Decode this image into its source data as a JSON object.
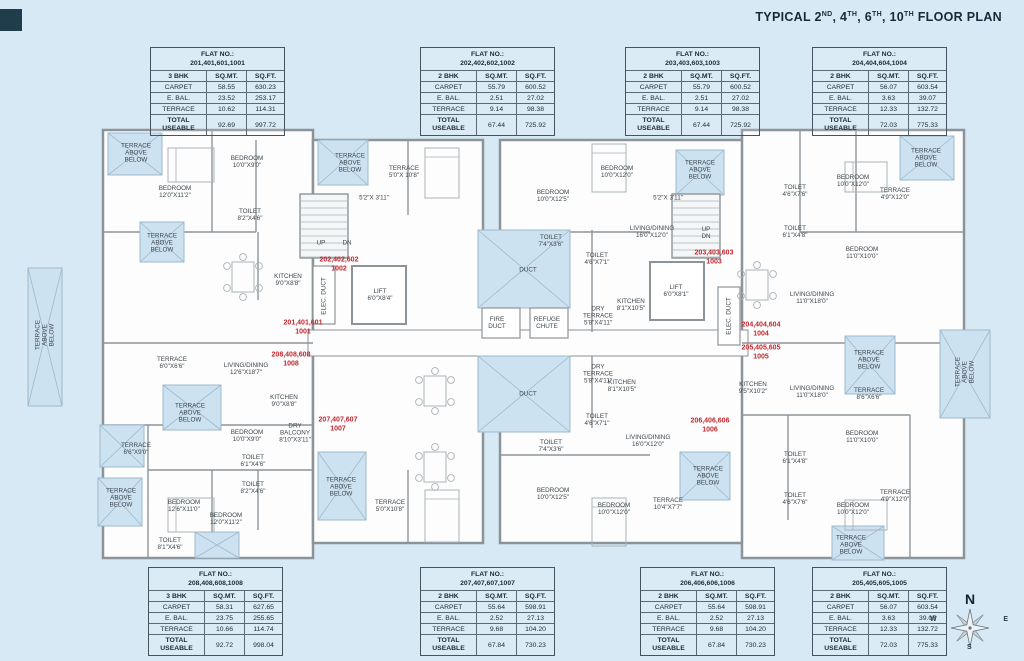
{
  "title": {
    "prefix": "TYPICAL ",
    "floors": [
      {
        "num": "2",
        "sup": "ND"
      },
      {
        "num": "4",
        "sup": "TH"
      },
      {
        "num": "6",
        "sup": "TH"
      },
      {
        "num": "10",
        "sup": "TH"
      }
    ],
    "suffix": " FLOOR PLAN",
    "full": "TYPICAL 2ND, 4TH, 6TH, 10TH FLOOR PLAN"
  },
  "colors": {
    "background": "#d7e9f5",
    "wall": "#8d9499",
    "room_fill": "#fdfdfd",
    "terrace_fill": "#cde2f1",
    "terrace_line": "#9db9cd",
    "flat_label_red": "#c0272d",
    "text_dark": "#1d2a33"
  },
  "tables": {
    "top": [
      {
        "flat_no_label": "FLAT NO.:",
        "flat_no": "201,401,601,1001",
        "unit_type": "3 BHK",
        "col_mt": "SQ.MT.",
        "col_ft": "SQ.FT.",
        "rows": [
          {
            "label": "CARPET",
            "sqmt": "58.55",
            "sqft": "630.23"
          },
          {
            "label": "E. BAL.",
            "sqmt": "23.52",
            "sqft": "253.17"
          },
          {
            "label": "TERRACE",
            "sqmt": "10.62",
            "sqft": "114.31"
          }
        ],
        "total": {
          "label": "TOTAL USEABLE",
          "sqmt": "92.69",
          "sqft": "997.72"
        }
      },
      {
        "flat_no_label": "FLAT NO.:",
        "flat_no": "202,402,602,1002",
        "unit_type": "2 BHK",
        "col_mt": "SQ.MT.",
        "col_ft": "SQ.FT.",
        "rows": [
          {
            "label": "CARPET",
            "sqmt": "55.79",
            "sqft": "600.52"
          },
          {
            "label": "E. BAL.",
            "sqmt": "2.51",
            "sqft": "27.02"
          },
          {
            "label": "TERRACE",
            "sqmt": "9.14",
            "sqft": "98.38"
          }
        ],
        "total": {
          "label": "TOTAL USEABLE",
          "sqmt": "67.44",
          "sqft": "725.92"
        }
      },
      {
        "flat_no_label": "FLAT NO.:",
        "flat_no": "203,403,603,1003",
        "unit_type": "2 BHK",
        "col_mt": "SQ.MT.",
        "col_ft": "SQ.FT.",
        "rows": [
          {
            "label": "CARPET",
            "sqmt": "55.79",
            "sqft": "600.52"
          },
          {
            "label": "E. BAL.",
            "sqmt": "2.51",
            "sqft": "27.02"
          },
          {
            "label": "TERRACE",
            "sqmt": "9.14",
            "sqft": "98.38"
          }
        ],
        "total": {
          "label": "TOTAL USEABLE",
          "sqmt": "67.44",
          "sqft": "725.92"
        }
      },
      {
        "flat_no_label": "FLAT NO.:",
        "flat_no": "204,404,604,1004",
        "unit_type": "2 BHK",
        "col_mt": "SQ.MT.",
        "col_ft": "SQ.FT.",
        "rows": [
          {
            "label": "CARPET",
            "sqmt": "56.07",
            "sqft": "603.54"
          },
          {
            "label": "E. BAL.",
            "sqmt": "3.63",
            "sqft": "39.07"
          },
          {
            "label": "TERRACE",
            "sqmt": "12.33",
            "sqft": "132.72"
          }
        ],
        "total": {
          "label": "TOTAL USEABLE",
          "sqmt": "72.03",
          "sqft": "775.33"
        }
      }
    ],
    "bottom": [
      {
        "flat_no_label": "FLAT NO.:",
        "flat_no": "208,408,608,1008",
        "unit_type": "3 BHK",
        "col_mt": "SQ.MT.",
        "col_ft": "SQ.FT.",
        "rows": [
          {
            "label": "CARPET",
            "sqmt": "58.31",
            "sqft": "627.65"
          },
          {
            "label": "E. BAL.",
            "sqmt": "23.75",
            "sqft": "255.65"
          },
          {
            "label": "TERRACE",
            "sqmt": "10.66",
            "sqft": "114.74"
          }
        ],
        "total": {
          "label": "TOTAL USEABLE",
          "sqmt": "92.72",
          "sqft": "998.04"
        }
      },
      {
        "flat_no_label": "FLAT NO.:",
        "flat_no": "207,407,607,1007",
        "unit_type": "2 BHK",
        "col_mt": "SQ.MT.",
        "col_ft": "SQ.FT.",
        "rows": [
          {
            "label": "CARPET",
            "sqmt": "55.64",
            "sqft": "598.91"
          },
          {
            "label": "E. BAL.",
            "sqmt": "2.52",
            "sqft": "27.13"
          },
          {
            "label": "TERRACE",
            "sqmt": "9.68",
            "sqft": "104.20"
          }
        ],
        "total": {
          "label": "TOTAL USEABLE",
          "sqmt": "67.84",
          "sqft": "730.23"
        }
      },
      {
        "flat_no_label": "FLAT NO.:",
        "flat_no": "206,406,606,1006",
        "unit_type": "2 BHK",
        "col_mt": "SQ.MT.",
        "col_ft": "SQ.FT.",
        "rows": [
          {
            "label": "CARPET",
            "sqmt": "55.64",
            "sqft": "598.91"
          },
          {
            "label": "E. BAL.",
            "sqmt": "2.52",
            "sqft": "27.13"
          },
          {
            "label": "TERRACE",
            "sqmt": "9.68",
            "sqft": "104.20"
          }
        ],
        "total": {
          "label": "TOTAL USEABLE",
          "sqmt": "67.84",
          "sqft": "730.23"
        }
      },
      {
        "flat_no_label": "FLAT NO.:",
        "flat_no": "205,405,605,1005",
        "unit_type": "2 BHK",
        "col_mt": "SQ.MT.",
        "col_ft": "SQ.FT.",
        "rows": [
          {
            "label": "CARPET",
            "sqmt": "56.07",
            "sqft": "603.54"
          },
          {
            "label": "E. BAL.",
            "sqmt": "3.63",
            "sqft": "39.07"
          },
          {
            "label": "TERRACE",
            "sqmt": "12.33",
            "sqft": "132.72"
          }
        ],
        "total": {
          "label": "TOTAL USEABLE",
          "sqmt": "72.03",
          "sqft": "775.33"
        }
      }
    ]
  },
  "plan": {
    "flat_labels": [
      {
        "t": "201,401,601\n1001",
        "x": 303,
        "y": 328
      },
      {
        "t": "202,402,602\n1002",
        "x": 339,
        "y": 265
      },
      {
        "t": "203,403,603\n1003",
        "x": 714,
        "y": 258
      },
      {
        "t": "204,404,604\n1004",
        "x": 761,
        "y": 330
      },
      {
        "t": "205,405,605\n1005",
        "x": 761,
        "y": 353
      },
      {
        "t": "206,406,606\n1006",
        "x": 710,
        "y": 426
      },
      {
        "t": "207,407,607\n1007",
        "x": 338,
        "y": 425
      },
      {
        "t": "208,408,608\n1008",
        "x": 291,
        "y": 360
      }
    ],
    "room_labels": [
      {
        "t": "TERRACE\nABOVE\nBELOW",
        "x": 350,
        "y": 163
      },
      {
        "t": "TERRACE\n5'0\"X 10'8\"",
        "x": 404,
        "y": 172
      },
      {
        "t": "5'2\"X 3'11\"",
        "x": 374,
        "y": 198
      },
      {
        "t": "BEDROOM\n10'0\"X12'5\"",
        "x": 553,
        "y": 196
      },
      {
        "t": "BEDROOM\n10'0\"X12'0\"",
        "x": 617,
        "y": 172
      },
      {
        "t": "5'2\"X 3'11\"",
        "x": 668,
        "y": 198
      },
      {
        "t": "TERRACE\nABOVE\nBELOW",
        "x": 700,
        "y": 170
      },
      {
        "t": "LIVING/DINING\n16'0\"X12'0\"",
        "x": 652,
        "y": 232
      },
      {
        "t": "TOILET\n7'4\"X3'6\"",
        "x": 551,
        "y": 241
      },
      {
        "t": "TOILET\n4'6\"X7'1\"",
        "x": 597,
        "y": 259
      },
      {
        "t": "UP",
        "x": 321,
        "y": 243
      },
      {
        "t": "DN",
        "x": 347,
        "y": 243
      },
      {
        "t": "ELEC. DUCT",
        "x": 324,
        "y": 296,
        "r": -90
      },
      {
        "t": "LIFT\n6'0\"X8'4\"",
        "x": 380,
        "y": 295
      },
      {
        "t": "UP\nDN",
        "x": 706,
        "y": 233
      },
      {
        "t": "LIFT\n6'0\"X8'1\"",
        "x": 676,
        "y": 291
      },
      {
        "t": "ELEC. DUCT",
        "x": 729,
        "y": 316,
        "r": -90
      },
      {
        "t": "KITCHEN\n8'1\"X10'5\"",
        "x": 631,
        "y": 305
      },
      {
        "t": "DRY\nTERRACE\n5'8\"X4'11\"",
        "x": 598,
        "y": 316
      },
      {
        "t": "FIRE\nDUCT",
        "x": 497,
        "y": 323
      },
      {
        "t": "REFUGE\nCHUTE",
        "x": 547,
        "y": 323
      },
      {
        "t": "DUCT",
        "x": 528,
        "y": 270
      },
      {
        "t": "DUCT",
        "x": 528,
        "y": 394
      },
      {
        "t": "DRY\nTERRACE\n5'8\"X4'11\"",
        "x": 598,
        "y": 374
      },
      {
        "t": "KITCHEN\n8'1\"X10'5\"",
        "x": 622,
        "y": 386
      },
      {
        "t": "KITCHEN\n9'5\"X10'2\"",
        "x": 753,
        "y": 388
      },
      {
        "t": "LIVING/DINING\n11'0\"X18'0\"",
        "x": 812,
        "y": 392
      },
      {
        "t": "TERRACE\nABOVE\nBELOW",
        "x": 869,
        "y": 360
      },
      {
        "t": "TERRACE\n8'6\"X6'6\"",
        "x": 869,
        "y": 394
      },
      {
        "t": "BEDROOM\n11'0\"X10'0\"",
        "x": 862,
        "y": 437
      },
      {
        "t": "TOILET\n6'1\"X4'8\"",
        "x": 795,
        "y": 458
      },
      {
        "t": "TOILET\n4'6\"X7'6\"",
        "x": 795,
        "y": 499
      },
      {
        "t": "BEDROOM\n10'0\"X12'0\"",
        "x": 853,
        "y": 509
      },
      {
        "t": "TERRACE\n4'9\"X12'0\"",
        "x": 895,
        "y": 496
      },
      {
        "t": "TERRACE\nABOVE\nBELOW",
        "x": 851,
        "y": 545
      },
      {
        "t": "LIVING/DINING\n16'0\"X12'0\"",
        "x": 648,
        "y": 441
      },
      {
        "t": "TOILET\n7'4\"X3'6\"",
        "x": 551,
        "y": 446
      },
      {
        "t": "TOILET\n4'6\"X7'1\"",
        "x": 597,
        "y": 420
      },
      {
        "t": "BEDROOM\n10'0\"X12'5\"",
        "x": 553,
        "y": 494
      },
      {
        "t": "BEDROOM\n10'0\"X12'0\"",
        "x": 614,
        "y": 509
      },
      {
        "t": "TERRACE\n10'4\"X7'7\"",
        "x": 668,
        "y": 504
      },
      {
        "t": "TERRACE\nABOVE\nBELOW",
        "x": 708,
        "y": 476
      },
      {
        "t": "TERRACE\n5'0\"X10'8\"",
        "x": 390,
        "y": 506
      },
      {
        "t": "TERRACE\nABOVE\nBELOW",
        "x": 341,
        "y": 487
      },
      {
        "t": "TERRACE\n6'0\"X6'6\"",
        "x": 172,
        "y": 363
      },
      {
        "t": "LIVING/DINING\n12'6\"X18'7\"",
        "x": 246,
        "y": 369
      },
      {
        "t": "KITCHEN\n9'0\"X8'8\"",
        "x": 284,
        "y": 401
      },
      {
        "t": "DRY\nBALCONY\n8'10\"X3'11\"",
        "x": 295,
        "y": 433
      },
      {
        "t": "TERRACE\nABOVE\nBELOW",
        "x": 190,
        "y": 413
      },
      {
        "t": "TERRACE\n6'6\"X9'0\"",
        "x": 136,
        "y": 449
      },
      {
        "t": "BEDROOM\n10'0\"X9'0\"",
        "x": 247,
        "y": 436
      },
      {
        "t": "TOILET\n6'1\"X4'6\"",
        "x": 253,
        "y": 461
      },
      {
        "t": "TOILET\n8'2\"X4'6\"",
        "x": 253,
        "y": 488
      },
      {
        "t": "TERRACE\nABOVE\nBELOW",
        "x": 121,
        "y": 498
      },
      {
        "t": "BEDROOM\n12'6\"X11'0\"",
        "x": 184,
        "y": 506
      },
      {
        "t": "BEDROOM\n12'0\"X11'2\"",
        "x": 226,
        "y": 519
      },
      {
        "t": "TOILET\n8'1\"X4'6\"",
        "x": 170,
        "y": 544
      },
      {
        "t": "TERRACE\nABOVE\nBELOW",
        "x": 136,
        "y": 153
      },
      {
        "t": "BEDROOM\n12'0\"X11'2\"",
        "x": 175,
        "y": 192
      },
      {
        "t": "BEDROOM\n10'0\"X9'0\"",
        "x": 247,
        "y": 162
      },
      {
        "t": "TOILET\n8'2\"X4'6\"",
        "x": 250,
        "y": 215
      },
      {
        "t": "KITCHEN\n9'0\"X8'8\"",
        "x": 288,
        "y": 280
      },
      {
        "t": "TERRACE\nABOVE\nBELOW",
        "x": 162,
        "y": 243
      },
      {
        "t": "TERRACE\nABOVE\nBELOW",
        "x": 45,
        "y": 335,
        "r": -90
      },
      {
        "t": "TERRACE\nABOVE\nBELOW",
        "x": 926,
        "y": 158
      },
      {
        "t": "BEDROOM\n10'0\"X12'0\"",
        "x": 853,
        "y": 181
      },
      {
        "t": "TERRACE\n4'9\"X12'0\"",
        "x": 895,
        "y": 194
      },
      {
        "t": "BEDROOM\n11'0\"X10'0\"",
        "x": 862,
        "y": 253
      },
      {
        "t": "TOILET\n6'1\"X4'8\"",
        "x": 795,
        "y": 232
      },
      {
        "t": "TOILET\n4'6\"X7'6\"",
        "x": 795,
        "y": 191
      },
      {
        "t": "LIVING/DINING\n11'0\"X18'0\"",
        "x": 812,
        "y": 298
      },
      {
        "t": "TERRACE\nABOVE\nBELOW",
        "x": 965,
        "y": 372,
        "r": -90
      }
    ]
  },
  "compass": {
    "north": "N",
    "south": "S",
    "east": "E",
    "west": "W"
  }
}
